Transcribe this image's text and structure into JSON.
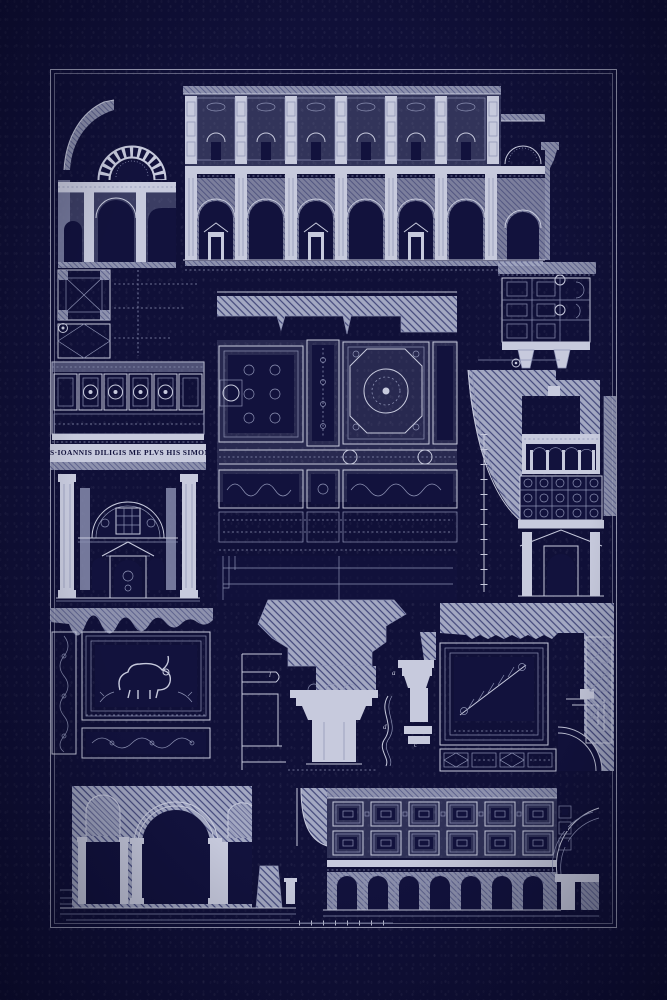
{
  "artwork": {
    "type": "architectural blueprint plate",
    "inscription": "S·IOANNIS DILIGIS ME PLVS HIS SIMON",
    "colors": {
      "background": "#101038",
      "paper": "#c7cadd",
      "ink": "#c7cadd",
      "ink_dim": "#8d92b4",
      "navy": "#12123d",
      "hatch_base": "#a3a8c2",
      "hatch_line": "#42477a"
    },
    "figure_labels": [
      {
        "text": "l"
      },
      {
        "text": "a"
      },
      {
        "text": "d"
      },
      {
        "text": "c"
      }
    ],
    "figures": [
      {
        "name": "building-section-elevation"
      },
      {
        "name": "palace-facade-elevation"
      },
      {
        "name": "ceiling-coffer-plan-fragment"
      },
      {
        "name": "vault-plan-fragment"
      },
      {
        "name": "coffered-soffit-band-with-inscription"
      },
      {
        "name": "portal-elevation"
      },
      {
        "name": "interior-wall-and-ceiling-elevation"
      },
      {
        "name": "arch-section-with-gallery"
      },
      {
        "name": "mosaic-panel-with-beast"
      },
      {
        "name": "capital-and-moulding-profiles"
      },
      {
        "name": "vault-ornament-corner"
      },
      {
        "name": "arcade-elevation"
      },
      {
        "name": "coffered-hall-side-elevation"
      }
    ]
  }
}
